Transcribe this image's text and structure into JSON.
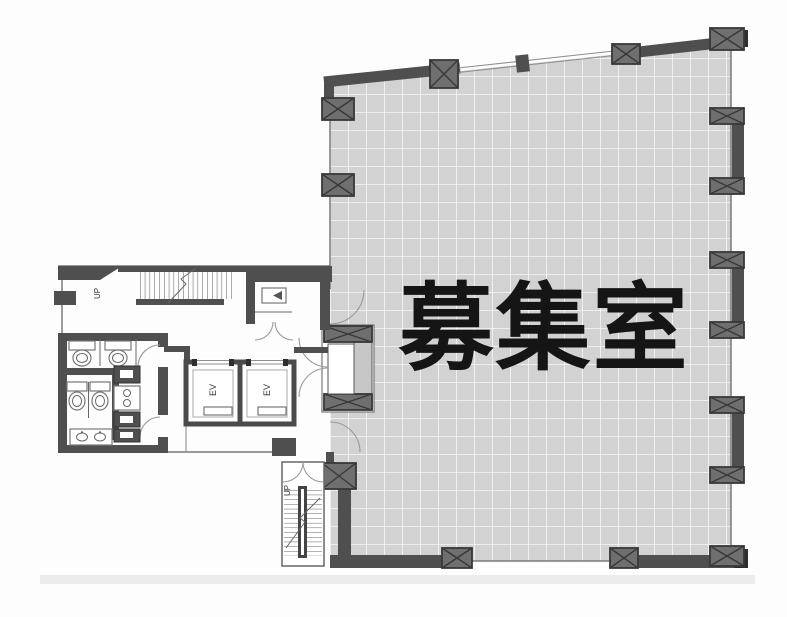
{
  "plan": {
    "room": {
      "label": "募集室",
      "fill": "#d2d2d2",
      "grid_color": "#ffffff"
    },
    "stairs_upper": {
      "label": "UP"
    },
    "stairs_lower": {
      "label": "UP"
    },
    "elevators": [
      {
        "label": "EV"
      },
      {
        "label": "EV"
      }
    ],
    "colors": {
      "wall": "#4f4f4f",
      "column_fill": "#6f6f6f",
      "column_stroke": "#383838",
      "text": "#151515"
    }
  }
}
